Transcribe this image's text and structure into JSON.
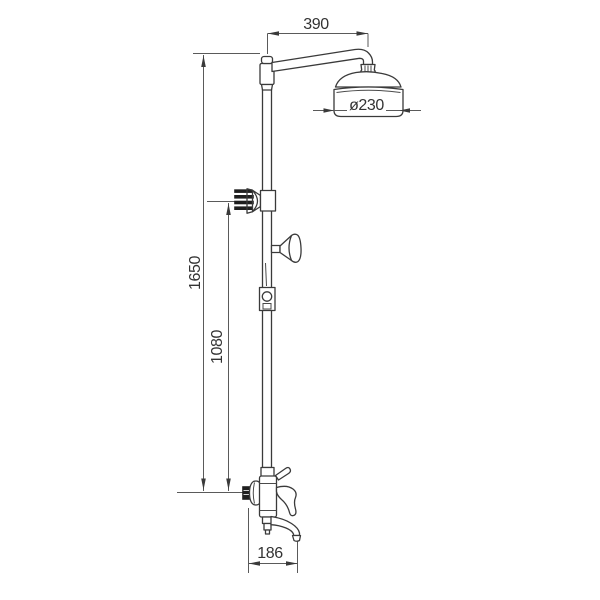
{
  "drawing": {
    "type": "technical-dimension-drawing",
    "dimensions": {
      "arm_reach": "390",
      "head_diameter": "ø230",
      "total_height": "1650",
      "upper_riser_height": "1080",
      "spout_reach": "186"
    },
    "colors": {
      "background": "#ffffff",
      "outline": "#3a3a3a",
      "dimension_line": "#5a5a5a",
      "text": "#333333"
    }
  }
}
